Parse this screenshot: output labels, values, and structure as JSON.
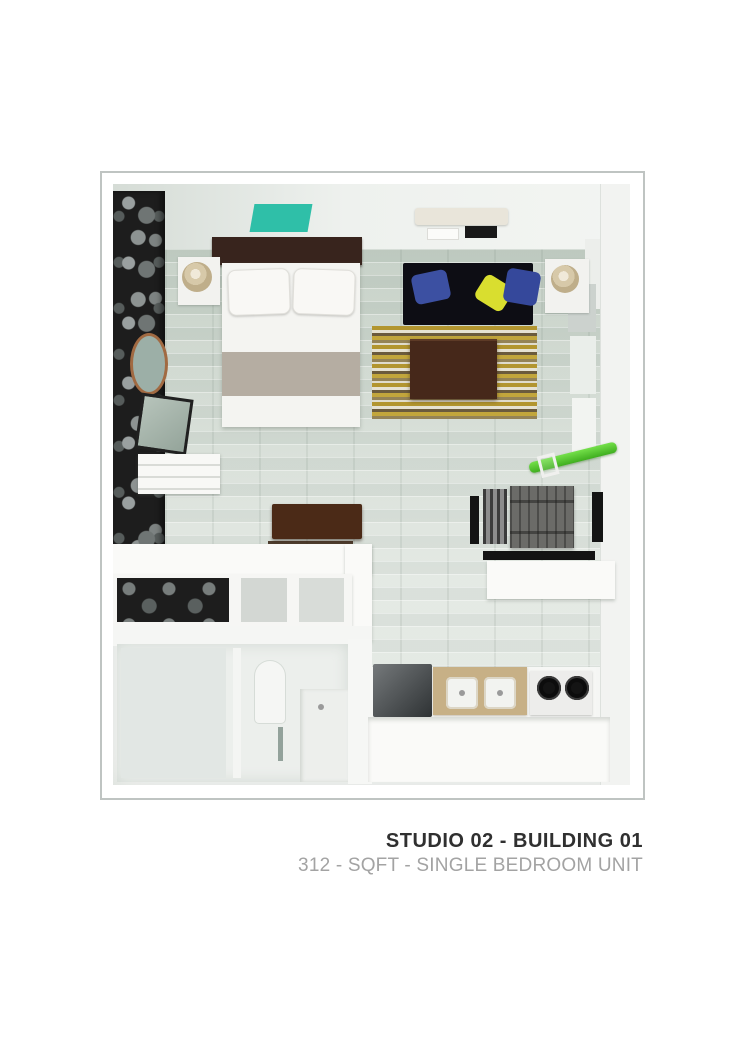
{
  "caption": {
    "title": "STUDIO 02 - BUILDING 01",
    "subtitle": "312 - SQFT - SINGLE BEDROOM UNIT"
  },
  "palette": {
    "teal_ceiling_panel": "#2fbfa8",
    "sofa": "#0d0d14",
    "pillow_blue": "#3c50a2",
    "pillow_blue_dark": "#35489b",
    "pillow_yellow": "#d9de2f",
    "coffee_table": "#46281a",
    "headboard": "#38241d",
    "desk": "#4b2a17",
    "bed_runner": "#b5ada2",
    "skateboard_green": "#57d32c",
    "sink_cabinet": "#c7b086",
    "accent_wall": "#1d1d1d",
    "floor": "#ccd4cb",
    "frame_border": "#bfc4c2",
    "title_text": "#303030",
    "subtitle_text": "#a3a3a3"
  },
  "floorplan": {
    "description": "3D top-down render of a studio apartment",
    "rooms": [
      "bedroom-living",
      "bathroom",
      "kitchen"
    ],
    "furniture": [
      "double-bed",
      "headboard",
      "bed-pillows",
      "bed-runner",
      "nightstand",
      "table-lamp",
      "sofa",
      "throw-pillows",
      "area-rug",
      "coffee-table",
      "round-mirror",
      "wall-mirror",
      "floating-shelf",
      "wall-desk",
      "storage-counter",
      "open-cubbies",
      "dining-table",
      "dining-chairs",
      "wall-shelf",
      "skateboard-rack",
      "refrigerator",
      "double-sink",
      "stove",
      "kitchen-counter",
      "toilet",
      "shower",
      "vanity",
      "ac-unit",
      "teal-ceiling-panel"
    ]
  }
}
